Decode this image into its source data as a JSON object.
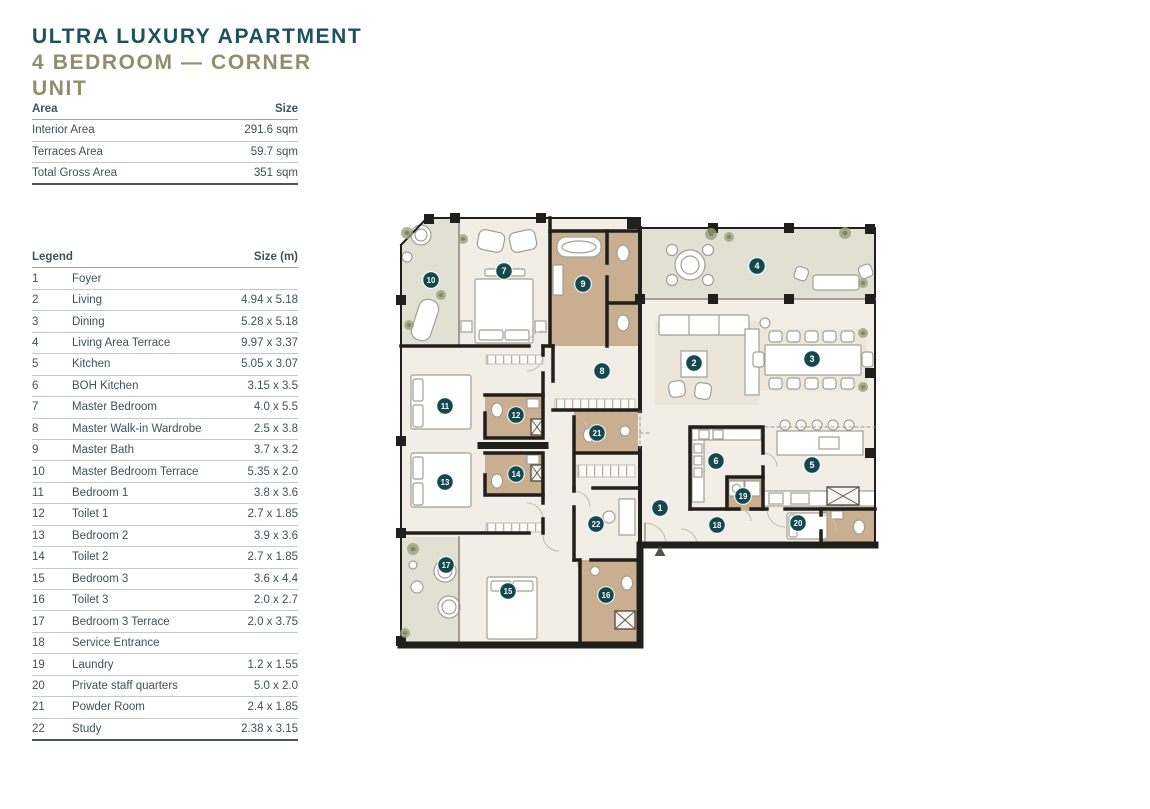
{
  "header": {
    "title": "ULTRA LUXURY APARTMENT",
    "subtitle": "4 BEDROOM — CORNER UNIT"
  },
  "area_table": {
    "col_label": "Area",
    "col_size": "Size",
    "rows": [
      {
        "label": "Interior Area",
        "size": "291.6 sqm"
      },
      {
        "label": "Terraces Area",
        "size": "59.7 sqm"
      },
      {
        "label": "Total Gross Area",
        "size": "351 sqm"
      }
    ]
  },
  "legend_table": {
    "col_label": "Legend",
    "col_size": "Size (m)",
    "rows": [
      {
        "num": "1",
        "name": "Foyer",
        "size": ""
      },
      {
        "num": "2",
        "name": "Living",
        "size": "4.94 x 5.18"
      },
      {
        "num": "3",
        "name": "Dining",
        "size": "5.28 x 5.18"
      },
      {
        "num": "4",
        "name": "Living Area Terrace",
        "size": "9.97 x 3.37"
      },
      {
        "num": "5",
        "name": "Kitchen",
        "size": "5.05 x 3.07"
      },
      {
        "num": "6",
        "name": "BOH Kitchen",
        "size": "3.15 x 3.5"
      },
      {
        "num": "7",
        "name": "Master Bedroom",
        "size": "4.0 x 5.5"
      },
      {
        "num": "8",
        "name": "Master Walk-in Wardrobe",
        "size": "2.5 x 3.8"
      },
      {
        "num": "9",
        "name": "Master Bath",
        "size": "3.7 x 3.2"
      },
      {
        "num": "10",
        "name": "Master Bedroom Terrace",
        "size": "5.35 x 2.0"
      },
      {
        "num": "11",
        "name": "Bedroom 1",
        "size": "3.8 x 3.6"
      },
      {
        "num": "12",
        "name": "Toilet 1",
        "size": "2.7 x 1.85"
      },
      {
        "num": "13",
        "name": "Bedroom 2",
        "size": "3.9 x 3.6"
      },
      {
        "num": "14",
        "name": "Toilet 2",
        "size": "2.7 x 1.85"
      },
      {
        "num": "15",
        "name": "Bedroom 3",
        "size": "3.6 x 4.4"
      },
      {
        "num": "16",
        "name": "Toilet 3",
        "size": "2.0 x 2.7"
      },
      {
        "num": "17",
        "name": "Bedroom 3 Terrace",
        "size": "2.0 x 3.75"
      },
      {
        "num": "18",
        "name": "Service Entrance",
        "size": ""
      },
      {
        "num": "19",
        "name": "Laundry",
        "size": "1.2 x 1.55"
      },
      {
        "num": "20",
        "name": "Private staff quarters",
        "size": "5.0 x 2.0"
      },
      {
        "num": "21",
        "name": "Powder Room",
        "size": "2.4 x 1.85"
      },
      {
        "num": "22",
        "name": "Study",
        "size": "2.38 x 3.15"
      }
    ]
  },
  "floor_plan": {
    "marker_color": "#11494f",
    "marker_text_color": "#ffffff",
    "entrance_icon": "entrance-arrow",
    "markers": [
      {
        "num": "1",
        "room": "foyer",
        "x": 267,
        "y": 305
      },
      {
        "num": "2",
        "room": "living",
        "x": 301,
        "y": 160
      },
      {
        "num": "3",
        "room": "dining",
        "x": 419,
        "y": 156
      },
      {
        "num": "4",
        "room": "living-area-terrace",
        "x": 364,
        "y": 63
      },
      {
        "num": "5",
        "room": "kitchen",
        "x": 419,
        "y": 262
      },
      {
        "num": "6",
        "room": "boh-kitchen",
        "x": 323,
        "y": 258
      },
      {
        "num": "7",
        "room": "master-bedroom",
        "x": 111,
        "y": 68
      },
      {
        "num": "8",
        "room": "master-walkin-wardrobe",
        "x": 209,
        "y": 168
      },
      {
        "num": "9",
        "room": "master-bath",
        "x": 190,
        "y": 81
      },
      {
        "num": "10",
        "room": "master-bedroom-terrace",
        "x": 38,
        "y": 77
      },
      {
        "num": "11",
        "room": "bedroom-1",
        "x": 52,
        "y": 203
      },
      {
        "num": "12",
        "room": "toilet-1",
        "x": 123,
        "y": 212
      },
      {
        "num": "13",
        "room": "bedroom-2",
        "x": 52,
        "y": 279
      },
      {
        "num": "14",
        "room": "toilet-2",
        "x": 123,
        "y": 271
      },
      {
        "num": "15",
        "room": "bedroom-3",
        "x": 115,
        "y": 388
      },
      {
        "num": "16",
        "room": "toilet-3",
        "x": 213,
        "y": 392
      },
      {
        "num": "17",
        "room": "bedroom-3-terrace",
        "x": 53,
        "y": 362
      },
      {
        "num": "18",
        "room": "service-entrance",
        "x": 324,
        "y": 322
      },
      {
        "num": "19",
        "room": "laundry",
        "x": 350,
        "y": 293
      },
      {
        "num": "20",
        "room": "private-staff-quarters",
        "x": 405,
        "y": 320
      },
      {
        "num": "21",
        "room": "powder-room",
        "x": 204,
        "y": 230
      },
      {
        "num": "22",
        "room": "study",
        "x": 203,
        "y": 321
      }
    ]
  },
  "colors": {
    "title_teal": "#1d525c",
    "subtitle_olive": "#918e6a",
    "room_cream": "#f2eee5",
    "terrace_green": "#e0e1d2",
    "bath_tan": "#c9af8f",
    "wall_black": "#211f1c"
  }
}
